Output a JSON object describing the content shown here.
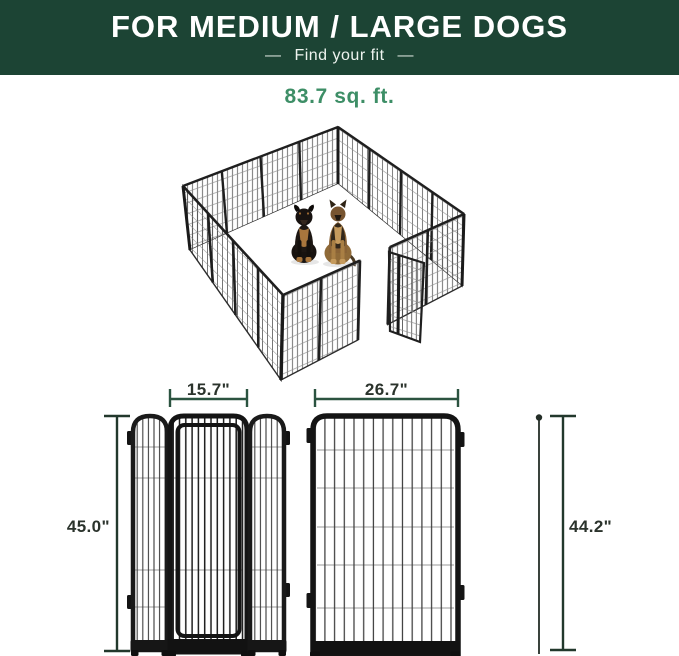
{
  "header": {
    "title": "FOR MEDIUM / LARGE DOGS",
    "subtitle": "Find your fit",
    "subtitle_dash": "—",
    "bg_color": "#1c4434",
    "text_color": "#ffffff"
  },
  "area": {
    "label": "83.7 sq. ft.",
    "color": "#3d8e66"
  },
  "illustration": {
    "name": "16-panel dog playpen, isometric view, door open",
    "dogs": [
      "rottweiler",
      "german-shepherd"
    ],
    "panel_color": "#1f1f1f"
  },
  "dimensions": {
    "door_section_width": "15.7\"",
    "panel_width": "26.7\"",
    "door_section_height": "45.0\"",
    "panel_height": "44.2\"",
    "line_color": "#2b5340",
    "text_color": "#2b332c"
  }
}
